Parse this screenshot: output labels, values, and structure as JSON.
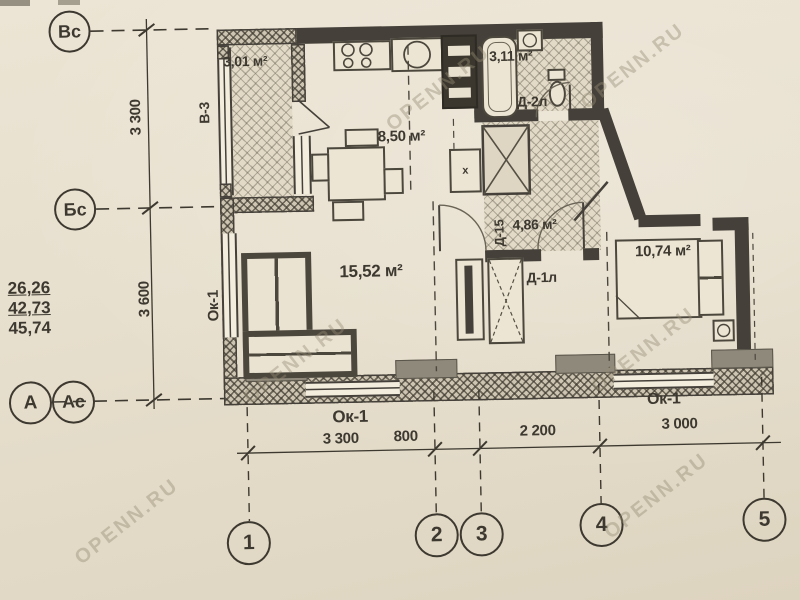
{
  "watermark": "OPENN.RU",
  "axis": {
    "row_top": "Вс",
    "row_mid": "Бс",
    "row_bottom_outer": "А",
    "row_bottom_inner": "Ас",
    "col_1": "1",
    "col_2": "2",
    "col_3": "3",
    "col_4": "4",
    "col_5": "5"
  },
  "dims": {
    "v1": "3 300",
    "v2": "3 600",
    "h1": "3 300",
    "h2": "800",
    "h3": "2 200",
    "h4": "3 000"
  },
  "totals": {
    "l1": "26,26",
    "l2": "42,73",
    "l3": "45,74"
  },
  "rooms": {
    "balcony_area": "3,01 м²",
    "kitchen_area": "8,50 м²",
    "bath_area": "3,11 м²",
    "hall_area": "4,86 м²",
    "living_area": "15,52 м²",
    "bedroom_area": "10,74 м²"
  },
  "tags": {
    "balcony_unit": "В-3",
    "door_bath": "Д-2л",
    "door_hall": "Д-15",
    "door_bedroom": "Д-1л",
    "window_left": "Ок-1",
    "window_bottom_left": "Ок-1",
    "window_bottom_right": "Ок-1",
    "vent_mark": "x"
  }
}
